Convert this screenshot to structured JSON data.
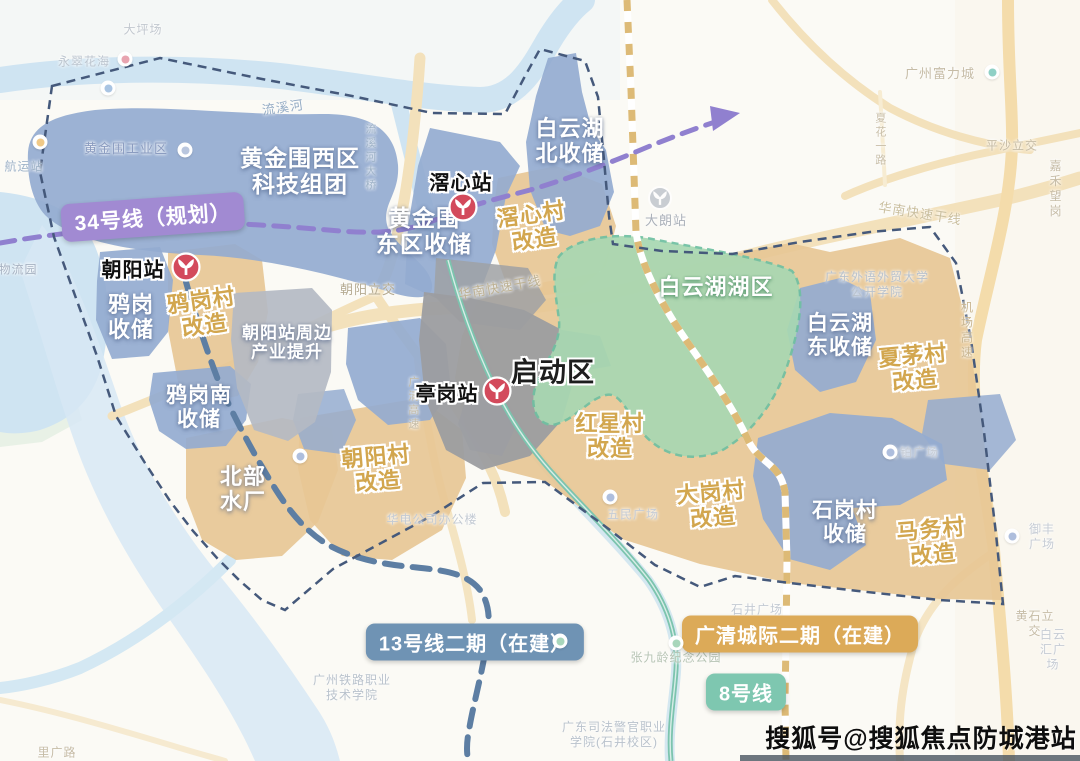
{
  "watermark": {
    "text": "搜狐号@搜狐焦点防城港站"
  },
  "colors": {
    "zone_blue": "#94abd0",
    "zone_tan": "#e7c795",
    "zone_green": "#a8d8b2",
    "zone_gray_dark": "#9c9da0",
    "zone_gray_light": "#b4bac3",
    "water": "#cfe4f2",
    "road": "#f3e1bb",
    "line34_purple": "#9080cf",
    "line13_slate": "#5d7ea3",
    "line8_teal": "#7cc4ae",
    "railway_tan": "#d9b267",
    "boundary_navy": "#45597b",
    "station_red": "#d34a5c",
    "pill_line34": "#a18ad2",
    "pill_line13": "#6f93b4",
    "pill_gqcj": "#dcaa58",
    "pill_line8": "#7ec7b0"
  },
  "legend_pills": [
    {
      "id": "line34",
      "text": "34号线（规划）",
      "bg": "#a18ad2",
      "x": 153,
      "y": 217,
      "rot": -4,
      "fs": 21
    },
    {
      "id": "line13",
      "text": "13号线二期（在建）",
      "bg": "#6f93b4",
      "x": 475,
      "y": 642,
      "rot": 0,
      "fs": 20
    },
    {
      "id": "gqcj",
      "text": "广清城际二期（在建）",
      "bg": "#dcaa58",
      "x": 800,
      "y": 634,
      "rot": 0,
      "fs": 20
    },
    {
      "id": "line8",
      "text": "8号线",
      "bg": "#7ec7b0",
      "x": 746,
      "y": 692,
      "rot": 0,
      "fs": 20
    }
  ],
  "stations": [
    {
      "name": "朝阳站",
      "label_x": 133,
      "label_y": 268,
      "icon_x": 186,
      "icon_y": 267
    },
    {
      "name": "滘心站",
      "label_x": 461,
      "label_y": 181,
      "icon_x": 463,
      "icon_y": 207
    },
    {
      "name": "亭岗站",
      "label_x": 447,
      "label_y": 392,
      "icon_x": 497,
      "icon_y": 391
    }
  ],
  "gray_station": {
    "x": 660,
    "y": 198
  },
  "zone_labels": [
    {
      "text": "黄金围西区\n科技组团",
      "style": "white",
      "x": 300,
      "y": 171,
      "fs": 23,
      "rot": 0
    },
    {
      "text": "黄金围\n东区收储",
      "style": "white",
      "x": 424,
      "y": 231,
      "fs": 23,
      "rot": 0
    },
    {
      "text": "白云湖\n北收储",
      "style": "white",
      "x": 570,
      "y": 141,
      "fs": 22,
      "rot": 0
    },
    {
      "text": "滘心村\n改造",
      "style": "tan",
      "x": 533,
      "y": 227,
      "fs": 22,
      "rot": -8
    },
    {
      "text": "鸦岗\n收储",
      "style": "white",
      "x": 131,
      "y": 317,
      "fs": 22,
      "rot": 0
    },
    {
      "text": "鸦岗村\n改造",
      "style": "tan",
      "x": 203,
      "y": 313,
      "fs": 22,
      "rot": -8
    },
    {
      "text": "朝阳站周边\n产业提升",
      "style": "white",
      "x": 287,
      "y": 343,
      "fs": 17,
      "rot": 0
    },
    {
      "text": "鸦岗南\n收储",
      "style": "white",
      "x": 199,
      "y": 408,
      "fs": 21,
      "rot": 0
    },
    {
      "text": "北部\n水厂",
      "style": "white",
      "x": 243,
      "y": 489,
      "fs": 22,
      "rot": 0
    },
    {
      "text": "朝阳村\n改造",
      "style": "tan",
      "x": 377,
      "y": 469,
      "fs": 22,
      "rot": -5
    },
    {
      "text": "启动区",
      "style": "black",
      "x": 553,
      "y": 373,
      "fs": 27,
      "rot": 0
    },
    {
      "text": "白云湖湖区",
      "style": "green",
      "x": 716,
      "y": 287,
      "fs": 22,
      "rot": 0
    },
    {
      "text": "红星村\n改造",
      "style": "tan",
      "x": 610,
      "y": 436,
      "fs": 22,
      "rot": 0
    },
    {
      "text": "大岗村\n改造",
      "style": "tan",
      "x": 712,
      "y": 505,
      "fs": 22,
      "rot": -5
    },
    {
      "text": "白云湖\n东收储",
      "style": "white",
      "x": 840,
      "y": 336,
      "fs": 21,
      "rot": 0
    },
    {
      "text": "夏茅村\n改造",
      "style": "tan",
      "x": 914,
      "y": 368,
      "fs": 22,
      "rot": -5
    },
    {
      "text": "石岗村\n收储",
      "style": "white",
      "x": 845,
      "y": 523,
      "fs": 21,
      "rot": 0
    },
    {
      "text": "马务村\n改造",
      "style": "tan",
      "x": 932,
      "y": 542,
      "fs": 22,
      "rot": -5
    }
  ],
  "map_labels": [
    {
      "text": "大坪场",
      "x": 143,
      "y": 30,
      "fs": 12,
      "c": "#c2c8cf",
      "rot": 0,
      "vertical": false
    },
    {
      "text": "永翠花海",
      "x": 84,
      "y": 62,
      "fs": 12,
      "c": "#bcc5cf",
      "rot": 0,
      "vertical": false
    },
    {
      "text": "流溪河",
      "x": 283,
      "y": 108,
      "fs": 13,
      "c": "#94abc4",
      "rot": -8,
      "vertical": false
    },
    {
      "text": "流溪河大桥",
      "x": 369,
      "y": 158,
      "fs": 11,
      "c": "#9fb3c8",
      "rot": 0,
      "vertical": true
    },
    {
      "text": "黄金围工业区",
      "x": 126,
      "y": 149,
      "fs": 13,
      "c": "#8b9cc0",
      "rot": 0,
      "vertical": false
    },
    {
      "text": "航运站",
      "x": 24,
      "y": 167,
      "fs": 12,
      "c": "#9fb3c8",
      "rot": 0,
      "vertical": false
    },
    {
      "text": "物流园",
      "x": 18,
      "y": 270,
      "fs": 12,
      "c": "#a7b2c2",
      "rot": 0,
      "vertical": false
    },
    {
      "text": "朝阳立交",
      "x": 368,
      "y": 290,
      "fs": 13,
      "c": "#b5ab92",
      "rot": 0,
      "vertical": false
    },
    {
      "text": "华南快速干线",
      "x": 500,
      "y": 288,
      "fs": 13,
      "c": "#bdb193",
      "rot": -10,
      "vertical": false
    },
    {
      "text": "大朗站",
      "x": 666,
      "y": 221,
      "fs": 13,
      "c": "#aab0b9",
      "rot": 0,
      "vertical": false
    },
    {
      "text": "广州富力城",
      "x": 940,
      "y": 74,
      "fs": 13,
      "c": "#c6bca6",
      "rot": 0,
      "vertical": false
    },
    {
      "text": "夏花一路",
      "x": 879,
      "y": 140,
      "fs": 11,
      "c": "#c9bfa9",
      "rot": 0,
      "vertical": true
    },
    {
      "text": "平沙立交",
      "x": 1012,
      "y": 146,
      "fs": 12,
      "c": "#c6bca6",
      "rot": 0,
      "vertical": false
    },
    {
      "text": "嘉禾望岗",
      "x": 1056,
      "y": 189,
      "fs": 12,
      "c": "#c6bca6",
      "rot": 0,
      "vertical": false
    },
    {
      "text": "华南快速干线",
      "x": 920,
      "y": 214,
      "fs": 13,
      "c": "#cabf9f",
      "rot": 9,
      "vertical": false
    },
    {
      "text": "广东外语外贸大学\n公开学院",
      "x": 877,
      "y": 285,
      "fs": 12,
      "c": "#b9c2cc",
      "rot": 0,
      "vertical": false
    },
    {
      "text": "机场高速",
      "x": 966,
      "y": 331,
      "fs": 12,
      "c": "#c9b691",
      "rot": 0,
      "vertical": true
    },
    {
      "text": "广清高速",
      "x": 412,
      "y": 404,
      "fs": 11,
      "c": "#c3baa4",
      "rot": 0,
      "vertical": true
    },
    {
      "text": "华电公司办公楼",
      "x": 432,
      "y": 520,
      "fs": 12,
      "c": "#c3cad3",
      "rot": 0,
      "vertical": false
    },
    {
      "text": "金铂广场",
      "x": 913,
      "y": 453,
      "fs": 12,
      "c": "#c6ccd5",
      "rot": 0,
      "vertical": false
    },
    {
      "text": "御丰广场",
      "x": 1042,
      "y": 537,
      "fs": 12,
      "c": "#c6ccd5",
      "rot": 0,
      "vertical": false
    },
    {
      "text": "五民广场",
      "x": 633,
      "y": 515,
      "fs": 12,
      "c": "#c6ccd5",
      "rot": 0,
      "vertical": false
    },
    {
      "text": "石井广场",
      "x": 757,
      "y": 610,
      "fs": 12,
      "c": "#c3cad3",
      "rot": 0,
      "vertical": false
    },
    {
      "text": "黄石立交",
      "x": 1035,
      "y": 624,
      "fs": 12,
      "c": "#c6bca6",
      "rot": 0,
      "vertical": false
    },
    {
      "text": "白云汇广场",
      "x": 1053,
      "y": 650,
      "fs": 12,
      "c": "#c6ccd5",
      "rot": 0,
      "vertical": false
    },
    {
      "text": "张九龄纪念公园",
      "x": 676,
      "y": 658,
      "fs": 12,
      "c": "#b7c4b4",
      "rot": 0,
      "vertical": false
    },
    {
      "text": "广州铁路职业\n技术学院",
      "x": 352,
      "y": 688,
      "fs": 12,
      "c": "#b9c2cc",
      "rot": 0,
      "vertical": false
    },
    {
      "text": "广东司法警官职业\n学院(石井校区)",
      "x": 614,
      "y": 735,
      "fs": 12,
      "c": "#b9c2cc",
      "rot": 0,
      "vertical": false
    },
    {
      "text": "里广路",
      "x": 57,
      "y": 753,
      "fs": 12,
      "c": "#c6bca6",
      "rot": 0,
      "vertical": false
    }
  ],
  "pois": [
    {
      "x": 125,
      "y": 59,
      "c": "#e8a4b0"
    },
    {
      "x": 108,
      "y": 88,
      "c": "#a9c4e2"
    },
    {
      "x": 40,
      "y": 142,
      "c": "#f0c987"
    },
    {
      "x": 992,
      "y": 72,
      "c": "#8fd0c5"
    },
    {
      "x": 890,
      "y": 452,
      "c": "#aebedd"
    },
    {
      "x": 1012,
      "y": 536,
      "c": "#aebedd"
    },
    {
      "x": 300,
      "y": 456,
      "c": "#aebedd"
    },
    {
      "x": 610,
      "y": 497,
      "c": "#aebedd"
    },
    {
      "x": 560,
      "y": 641,
      "c": "#a8d6bb"
    },
    {
      "x": 676,
      "y": 643,
      "c": "#a8d6bb"
    },
    {
      "x": 185,
      "y": 150,
      "c": "#b9c6de"
    }
  ]
}
